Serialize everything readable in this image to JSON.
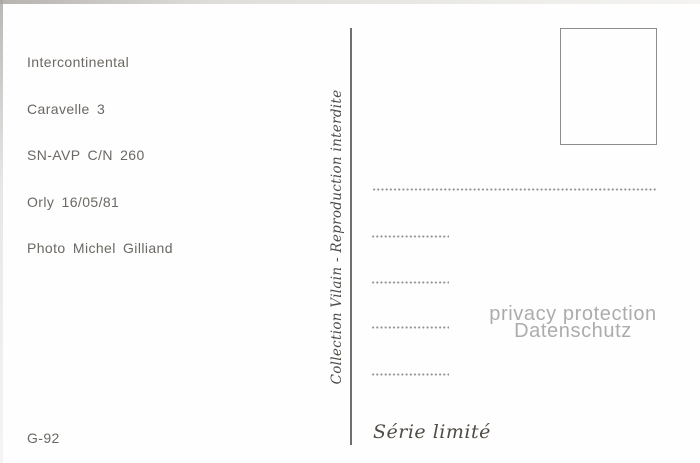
{
  "postcard": {
    "info_block": {
      "lines": [
        "Intercontinental",
        "Caravelle 3",
        "SN-AVP C/N 260",
        "Orly 16/05/81",
        "Photo Michel Gilliand"
      ]
    },
    "spine_text": "Collection Vilain - Reproduction interdite",
    "stamp_box": {
      "present": "true"
    },
    "address_lines": {
      "long_count": 1,
      "short_count": 4
    },
    "watermark": {
      "line1": "privacy protection",
      "line2": "Datenschutz"
    },
    "catalog_number": "G-92",
    "series_label": "Série limité",
    "colors": {
      "ink": "#6b6863",
      "script_ink": "#4f4b46",
      "divider": "#6f6f6f",
      "dots": "#8f8f8f",
      "watermark": "#acacac",
      "stamp_border": "#8e8c89",
      "background": "#fefefe"
    }
  }
}
